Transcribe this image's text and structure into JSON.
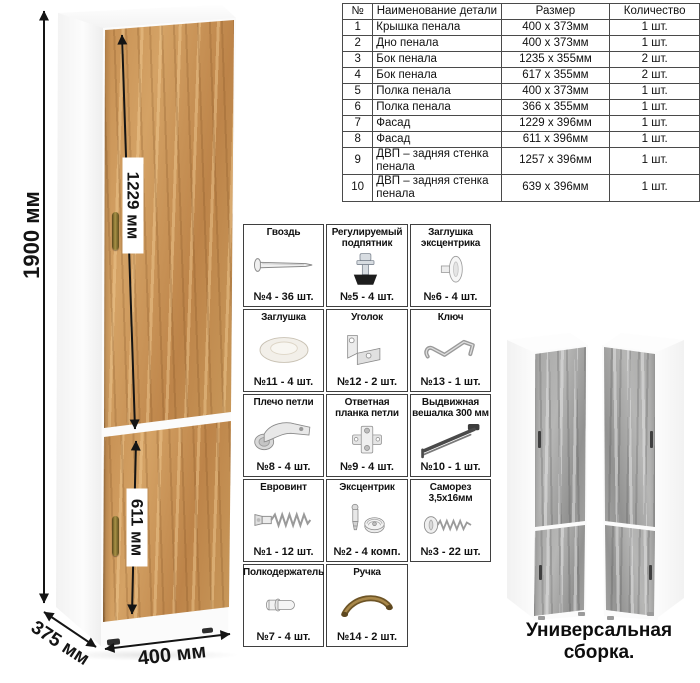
{
  "drawing": {
    "dim_height": "1900 мм",
    "dim_upper_door": "1229 мм",
    "dim_lower_door": "611 мм",
    "dim_width": "400 мм",
    "dim_depth": "375 мм"
  },
  "caption": "Универсальная сборка.",
  "parts_table": {
    "headers": [
      "№",
      "Наименование детали",
      "Размер",
      "Количество"
    ],
    "rows": [
      [
        "1",
        "Крышка пенала",
        "400 х 373мм",
        "1 шт."
      ],
      [
        "2",
        "Дно пенала",
        "400 х 373мм",
        "1 шт."
      ],
      [
        "3",
        "Бок пенала",
        "1235 х 355мм",
        "2 шт."
      ],
      [
        "4",
        "Бок пенала",
        "617 х 355мм",
        "2 шт."
      ],
      [
        "5",
        "Полка пенала",
        "400 х 373мм",
        "1 шт."
      ],
      [
        "6",
        "Полка пенала",
        "366 х 355мм",
        "1 шт."
      ],
      [
        "7",
        "Фасад",
        "1229 х 396мм",
        "1 шт."
      ],
      [
        "8",
        "Фасад",
        "611 х 396мм",
        "1 шт."
      ],
      [
        "9",
        "ДВП – задняя стенка пенала",
        "1257 х 396мм",
        "1 шт."
      ],
      [
        "10",
        "ДВП – задняя стенка пенала",
        "639 х 396мм",
        "1 шт."
      ]
    ]
  },
  "hardware": {
    "items": [
      {
        "name": "Гвоздь",
        "count": "№4 - 36 шт.",
        "icon": "nail-icon"
      },
      {
        "name": "Регулируемый подпятник",
        "count": "№5 - 4 шт.",
        "icon": "adjustable-foot-icon"
      },
      {
        "name": "Заглушка эксцентрика",
        "count": "№6 - 4 шт.",
        "icon": "cam-cover-icon"
      },
      {
        "name": "Заглушка",
        "count": "№11 - 4 шт.",
        "icon": "cap-icon"
      },
      {
        "name": "Уголок",
        "count": "№12 - 2 шт.",
        "icon": "corner-bracket-icon"
      },
      {
        "name": "Ключ",
        "count": "№13 - 1 шт.",
        "icon": "key-icon"
      },
      {
        "name": "Плечо петли",
        "count": "№8 - 4 шт.",
        "icon": "hinge-arm-icon"
      },
      {
        "name": "Ответная планка петли",
        "count": "№9 - 4 шт.",
        "icon": "hinge-plate-icon"
      },
      {
        "name": "Выдвижная вешалка 300 мм",
        "count": "№10 - 1 шт.",
        "icon": "pullout-hanger-icon"
      },
      {
        "name": "Евровинт",
        "count": "№1 - 12 шт.",
        "icon": "confirmat-screw-icon"
      },
      {
        "name": "Эксцентрик",
        "count": "№2 - 4 комп.",
        "icon": "cam-lock-icon"
      },
      {
        "name": "Саморез 3,5х16мм",
        "count": "№3 - 22 шт.",
        "icon": "self-tapping-screw-icon"
      },
      {
        "name": "Полкодержатель",
        "count": "№7 - 4 шт.",
        "icon": "shelf-pin-icon"
      },
      {
        "name": "Ручка",
        "count": "№14 - 2 шт.",
        "icon": "handle-icon"
      }
    ]
  },
  "colors": {
    "oak": "#c68f52",
    "gray_wood": "#a3a3a2",
    "arrow": "#141414",
    "table_border": "#4a4a4a",
    "handle_bronze": "#8a7030"
  }
}
